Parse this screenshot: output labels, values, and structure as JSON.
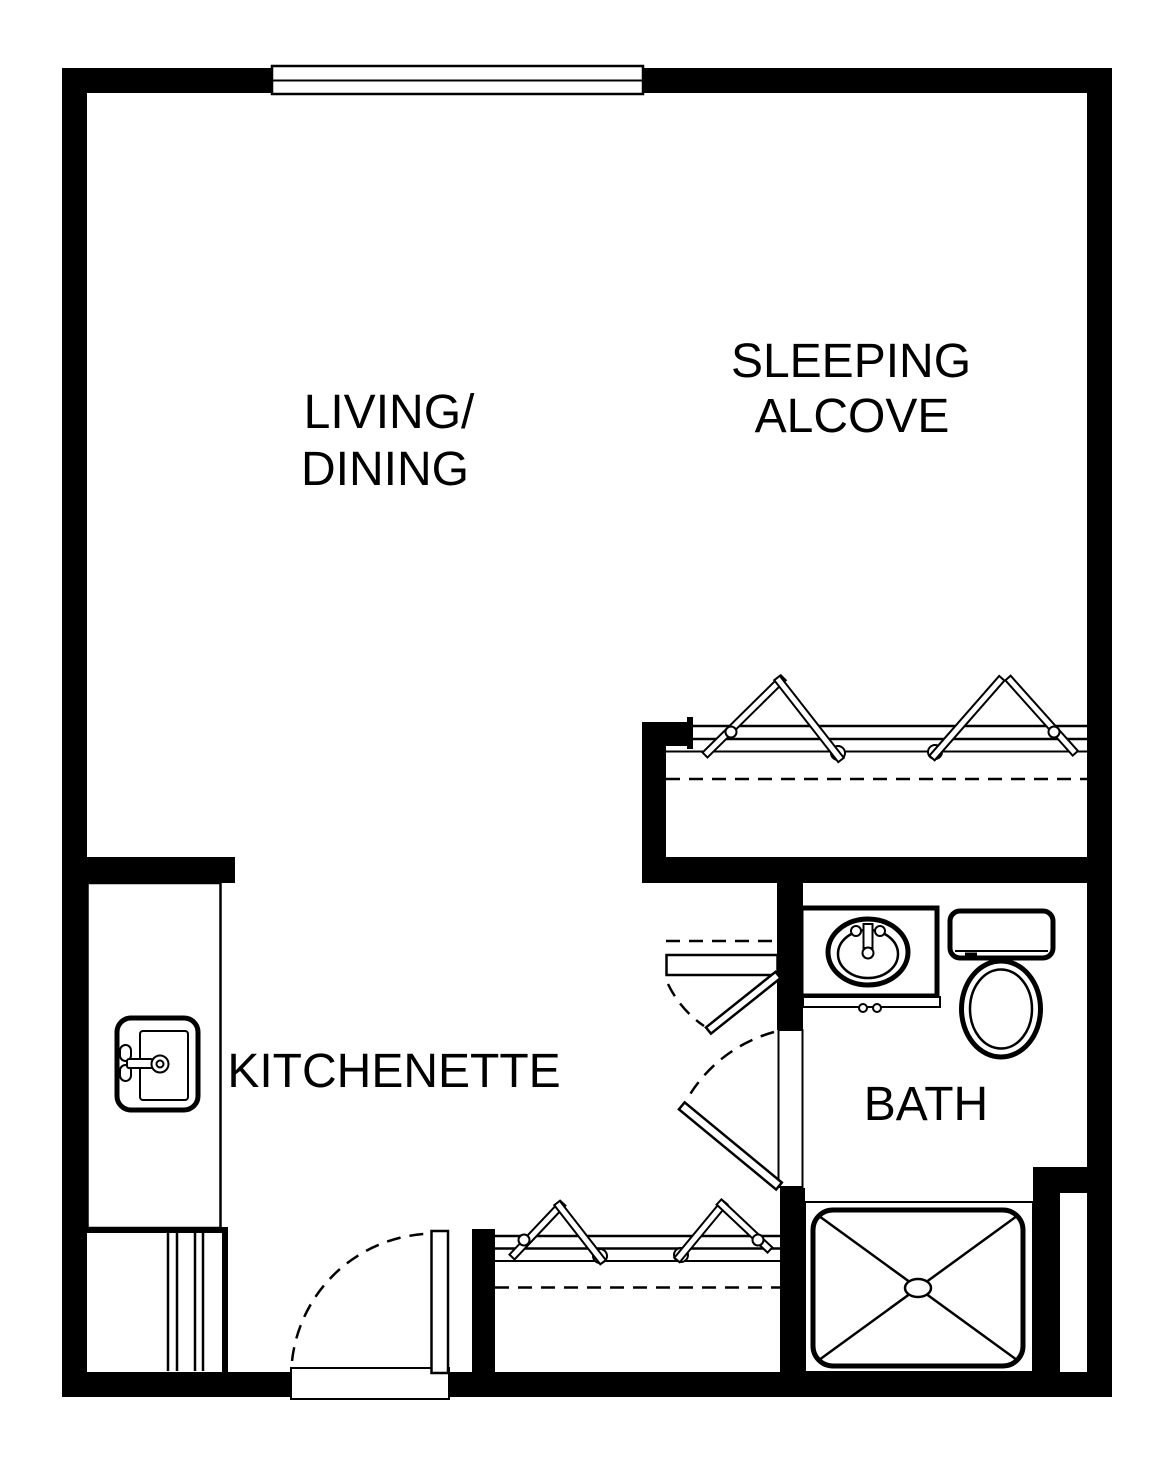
{
  "colors": {
    "line": "#000000",
    "background": "#ffffff"
  },
  "rooms": {
    "living_dining": {
      "label_line1": "LIVING/",
      "label_line2": "DINING"
    },
    "sleeping_alcove": {
      "label_line1": "SLEEPING",
      "label_line2": "ALCOVE"
    },
    "kitchenette": {
      "label": "KITCHENETTE"
    },
    "bath": {
      "label": "BATH"
    }
  },
  "fixtures": {
    "window": "window",
    "kitchen_sink": "kitchen-sink",
    "kitchen_counter": "kitchen-counter",
    "vanity_sink": "vanity-sink",
    "toilet": "toilet",
    "shower": "shower-stall",
    "entry_door": "entry-door",
    "bath_door": "bath-door",
    "linen_closet_door": "linen-closet-door",
    "closet_rods": [
      "sleeping-alcove-closet-rod",
      "entry-closet-rod"
    ],
    "hangers": "clothes-hangers"
  }
}
